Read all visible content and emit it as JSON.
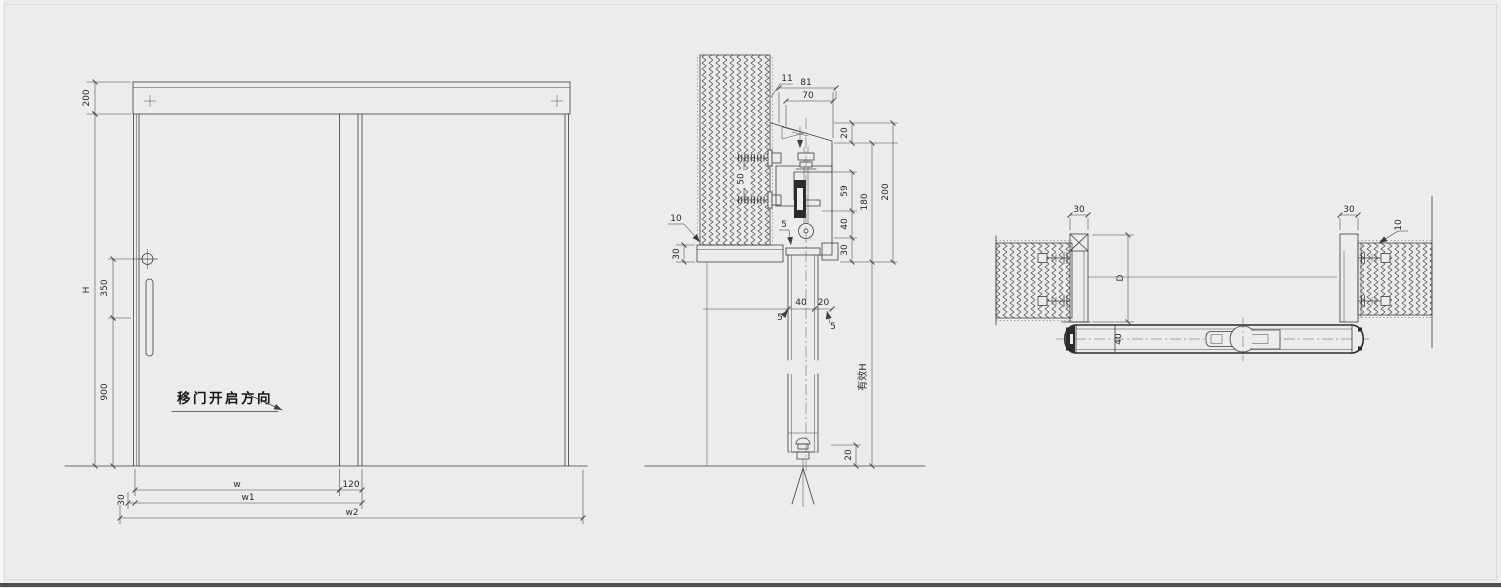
{
  "colors": {
    "background": "#ebedec",
    "line": "#3e3e3e",
    "text": "#2a2a2a"
  },
  "elevation": {
    "open_direction": "移门开启方向",
    "dims": {
      "track_height": "200",
      "door_height": "H",
      "handle_offset": "350",
      "handle_height": "900",
      "width": "w",
      "overlap": "120",
      "side_overlap": "30",
      "width1": "w1",
      "width2": "w2"
    }
  },
  "section_vertical": {
    "dims": {
      "d11": "11",
      "d81": "81",
      "d70": "70",
      "d20_top": "20",
      "d59": "59",
      "d40_chain": "40",
      "d30_chain": "30",
      "d180": "180",
      "d200": "200",
      "d50": "50",
      "d10": "10",
      "d30_beam": "30",
      "d5_wall": "5",
      "d40_panel": "40",
      "d20_gap": "20",
      "d5_left": "5",
      "d5_right": "5",
      "d20_floor": "20",
      "effective_height": "有效H"
    }
  },
  "section_horizontal": {
    "dims": {
      "d30_left": "30",
      "dD": "D",
      "d40_leaf": "40",
      "d30_right": "30",
      "d10": "10"
    }
  }
}
